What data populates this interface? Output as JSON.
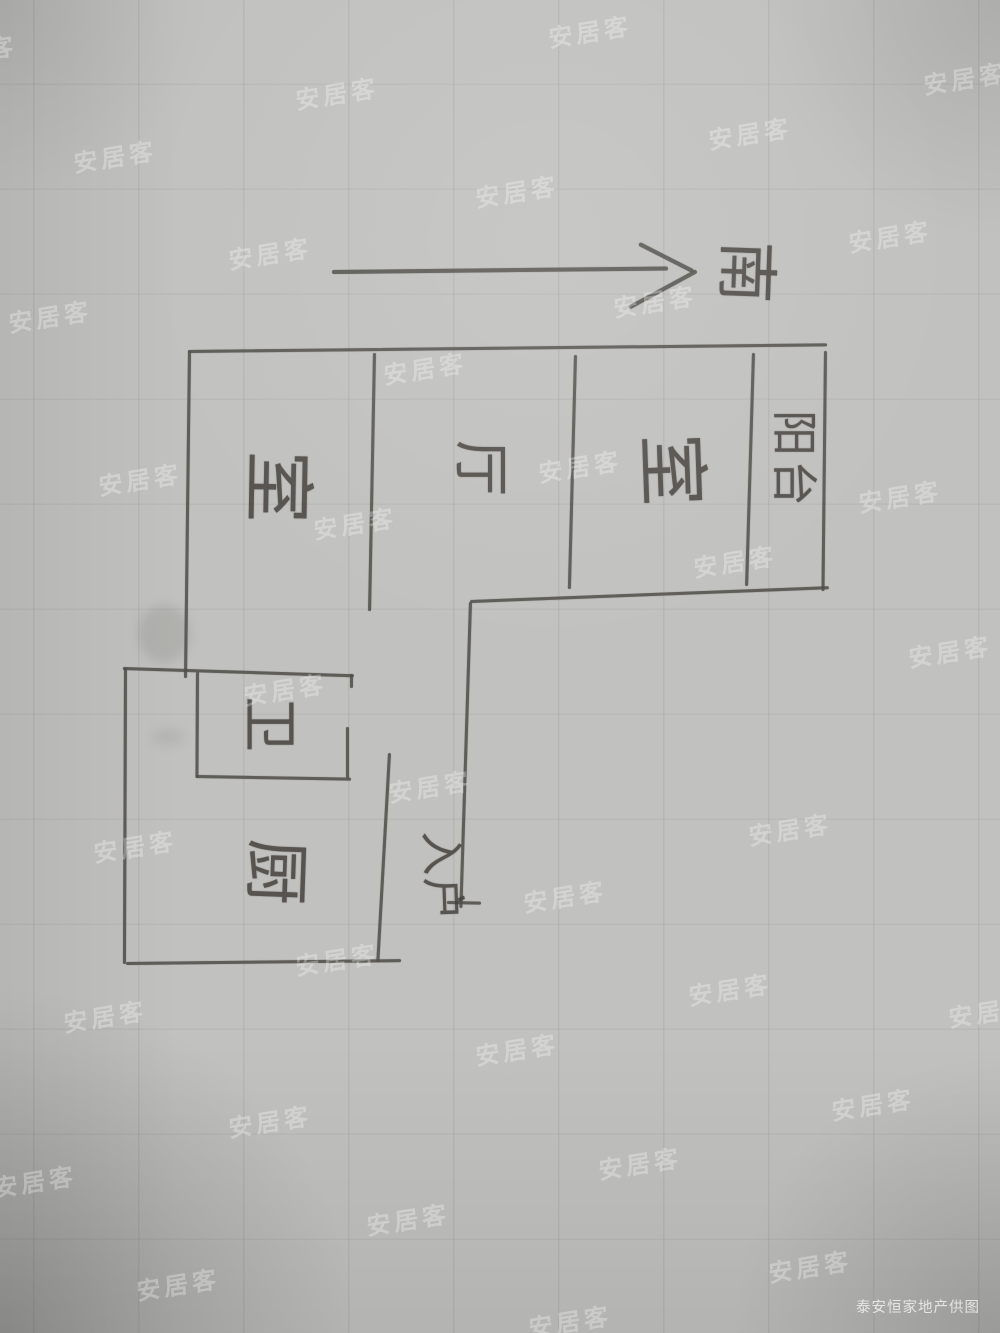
{
  "compass": {
    "direction_label": "南"
  },
  "floor_plan": {
    "rooms": [
      {
        "name": "bedroom-left",
        "label": "室"
      },
      {
        "name": "living-room",
        "label": "厅"
      },
      {
        "name": "bedroom-right",
        "label": "室"
      },
      {
        "name": "balcony",
        "label": "阳台"
      },
      {
        "name": "bathroom",
        "label": "卫"
      },
      {
        "name": "kitchen",
        "label": "厨"
      },
      {
        "name": "entrance",
        "label": "入户"
      }
    ]
  },
  "watermark": {
    "text": "安居客",
    "color": "rgba(255,255,255,0.30)"
  },
  "credit": {
    "text": "泰安恒家地产供图",
    "color": "rgba(255,255,255,0.72)"
  },
  "colors": {
    "pencil": "#52504a",
    "paper": "#c1c1bf"
  }
}
